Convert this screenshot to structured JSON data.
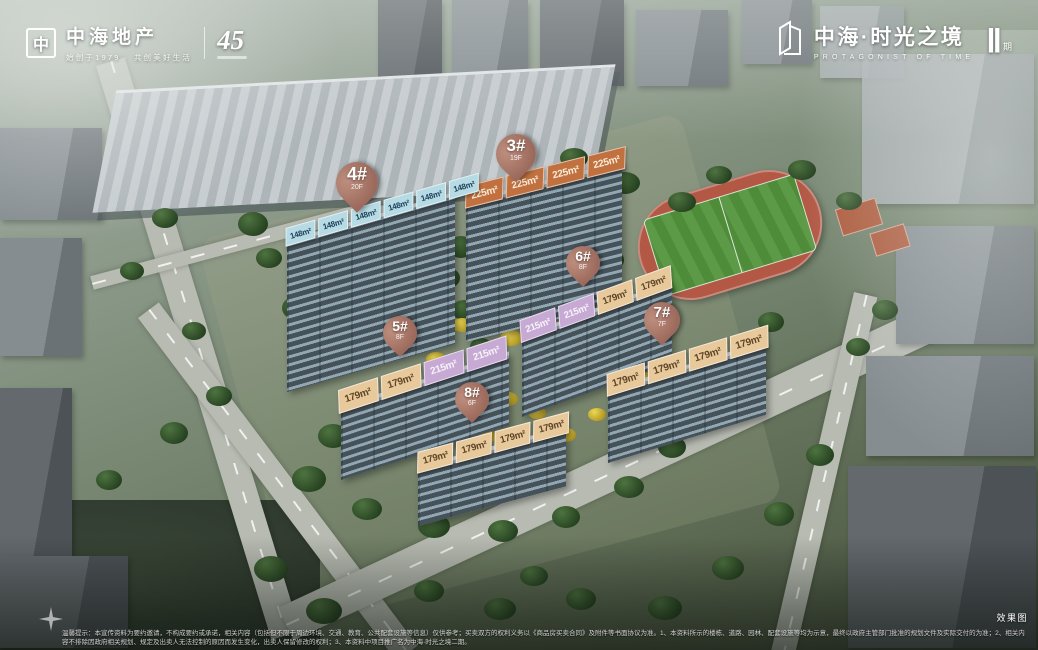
{
  "header": {
    "left": {
      "logo_glyph": "中",
      "brand": "中海地产",
      "tagline": "始创于1979 · 共创美好生活",
      "anniversary_number": "45"
    },
    "right": {
      "brand": "中海·时光之境",
      "subtitle": "PROTAGONIST OF TIME",
      "phase_numeral": "Ⅱ",
      "phase_label": "期"
    }
  },
  "buildings": [
    {
      "id": "3#",
      "floors": "19F",
      "tags": [
        "225m²",
        "225m²",
        "225m²",
        "225m²"
      ]
    },
    {
      "id": "4#",
      "floors": "20F",
      "tags": [
        "148m²",
        "148m²",
        "148m²",
        "148m²",
        "148m²",
        "148m²"
      ]
    },
    {
      "id": "5#",
      "floors": "8F",
      "tags": [
        "179m²",
        "179m²",
        "215m²",
        "215m²"
      ]
    },
    {
      "id": "6#",
      "floors": "8F",
      "tags": [
        "215m²",
        "215m²",
        "179m²",
        "179m²"
      ]
    },
    {
      "id": "7#",
      "floors": "7F",
      "tags": [
        "179m²",
        "179m²",
        "179m²",
        "179m²"
      ]
    },
    {
      "id": "8#",
      "floors": "6F",
      "tags": [
        "179m²",
        "179m²",
        "179m²",
        "179m²"
      ]
    }
  ],
  "colors": {
    "marker_bg": "#9c6a5c",
    "marker_highlight": "#bd8e7e",
    "tags": {
      "148m²": {
        "bg": "#b7dbe4",
        "text": "#1d3f58"
      },
      "225m²": {
        "bg": "#c0713f",
        "text": "#f9ecd9"
      },
      "215m²": {
        "bg": "#c7aad3",
        "text": "#f8f2fa"
      },
      "179m²": {
        "bg": "#e7c99c",
        "text": "#5e4526"
      }
    }
  },
  "footer": {
    "disclaimer": "温馨提示：本宣传资料为要约邀请，不构成要约或承诺，相关内容（包括但不限于周边环境、交通、教育、公共配套设施等信息）仅供参考；买卖双方的权利义务以《商品房买卖合同》及附件等书面协议为准。1、本资料所示的楼栋、道路、园林、配套设施等均为示意，最终以政府主管部门批准的规划文件及实际交付的为准；2、相关内容不排除因政府相关规划、规定及出卖人无法控制的原因而发生变化，出卖人保留修改的权利；3、本资料中项目推广名为中海·时光之境二期。",
    "render_label": "效果图"
  }
}
